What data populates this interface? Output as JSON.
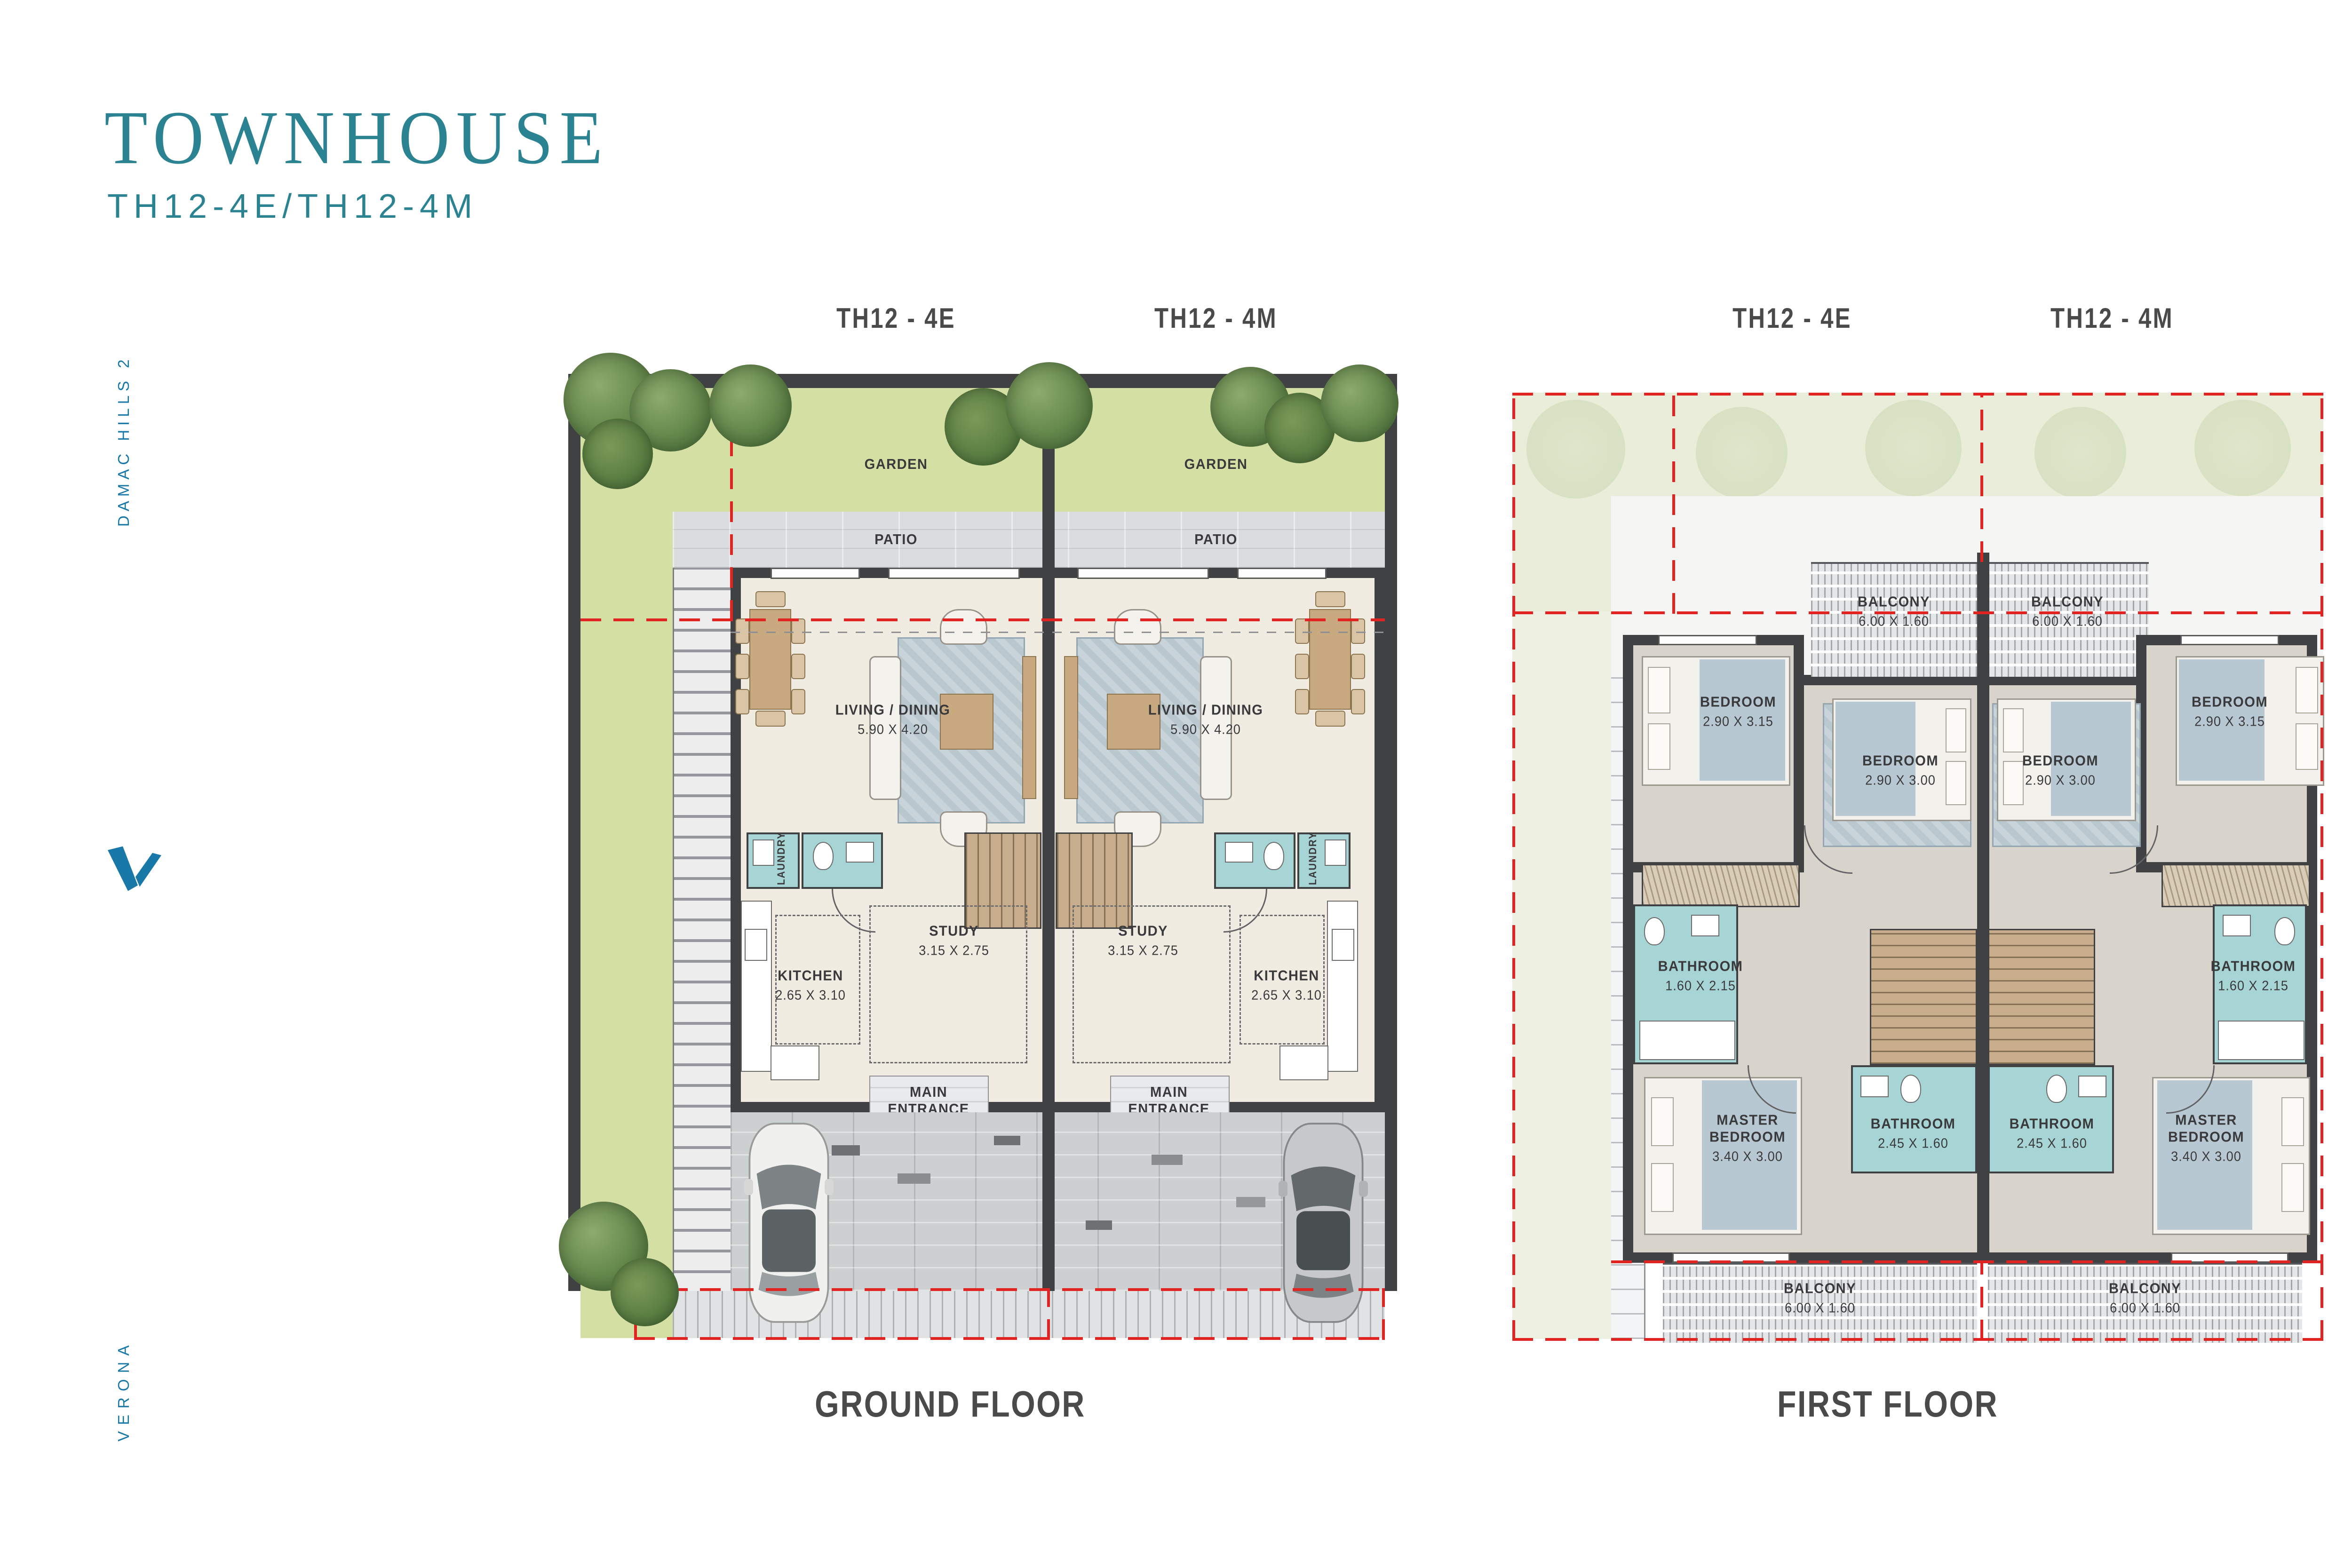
{
  "header": {
    "title": "TOWNHOUSE",
    "subtitle": "TH12-4E/TH12-4M"
  },
  "sidebar": {
    "project": "DAMAC HILLS 2",
    "community": "VERONA",
    "logo": "damac-v-logo"
  },
  "units": {
    "left": "TH12 - 4E",
    "right": "TH12 - 4M"
  },
  "ground_floor": {
    "caption": "GROUND FLOOR",
    "garden": "GARDEN",
    "patio": "PATIO",
    "living": {
      "name": "LIVING / DINING",
      "dims": "5.90 X 4.20"
    },
    "study": {
      "name": "STUDY",
      "dims": "3.15 X 2.75"
    },
    "kitchen": {
      "name": "KITCHEN",
      "dims": "2.65 X 3.10"
    },
    "laundry": "LAUNDRY",
    "wm": "WM.",
    "entrance_l1": "MAIN",
    "entrance_l2": "ENTRANCE",
    "stair_numbers": "1-19"
  },
  "first_floor": {
    "caption": "FIRST FLOOR",
    "balcony": {
      "name": "BALCONY",
      "dims": "6.00 X 1.60"
    },
    "bedroom_a": {
      "name": "BEDROOM",
      "dims": "2.90 X 3.15"
    },
    "bedroom_b": {
      "name": "BEDROOM",
      "dims": "2.90 X 3.00"
    },
    "bathroom_a": {
      "name": "BATHROOM",
      "dims": "1.60 X 2.15"
    },
    "bathroom_b": {
      "name": "BATHROOM",
      "dims": "2.45 X 1.60"
    },
    "master_l1": "MASTER",
    "master_l2": "BEDROOM",
    "master_dims": "3.40 X 3.00",
    "stair_numbers": "1-19"
  },
  "colors": {
    "accent_teal": "#2b8391",
    "brand_blue": "#1878a8",
    "boundary_red": "#e12421",
    "wall_dark": "#3f4142",
    "bathroom_teal": "#a7d4d4",
    "garden_green": "#d3dfa3",
    "floor_cream": "#f1ece2"
  }
}
